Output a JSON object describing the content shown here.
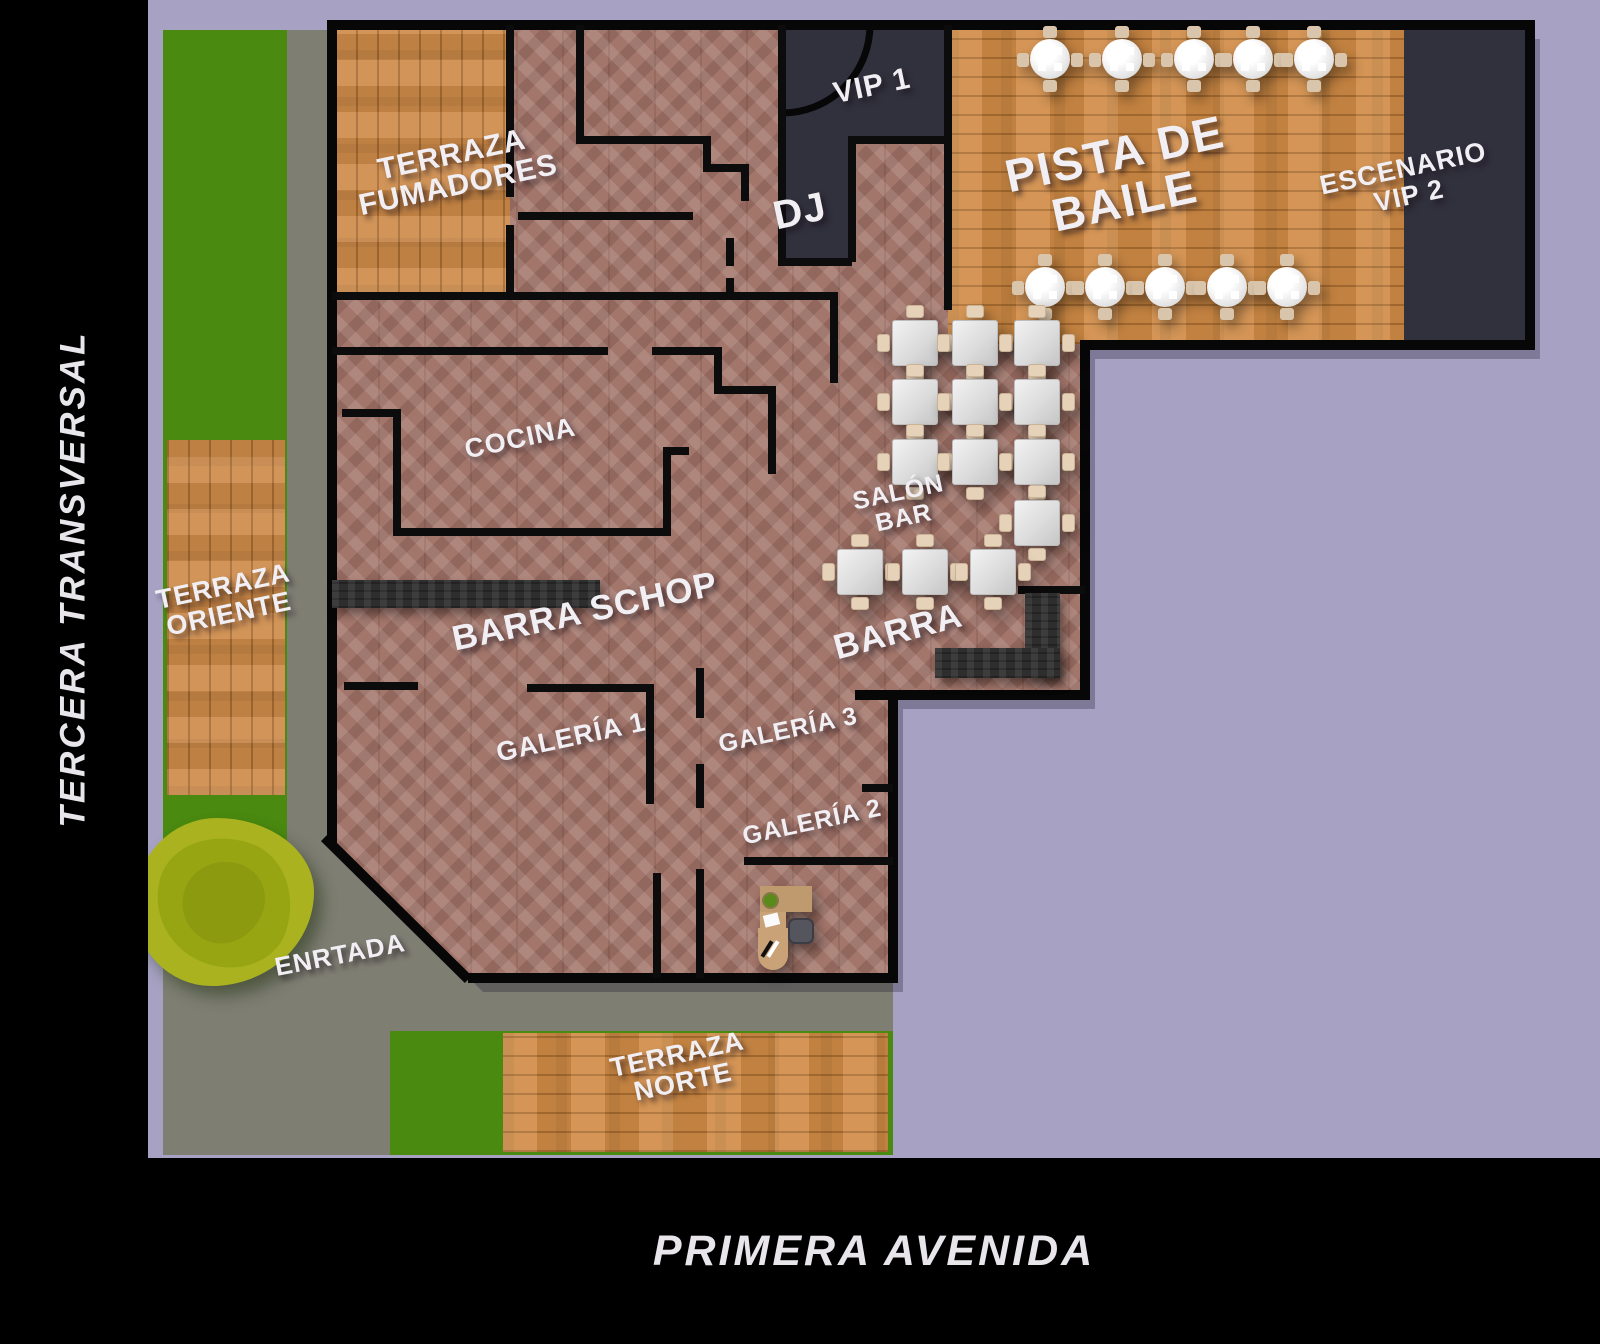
{
  "title": "Plano del local — floor plan",
  "colors": {
    "background_lavender": "#a7a2c4",
    "street_black": "#000000",
    "grass_green": "#4a8a10",
    "road_gray": "#7e7e73",
    "brick_floor": "#a3766b",
    "deck_wood": "#cd8a48",
    "dance_wood": "#d08b45",
    "dark_room": "#31313d",
    "counter_dark": "#2e2e2e",
    "wall_black": "#070707",
    "table_white": "#ececec",
    "chair_beige": "#d9c5ab",
    "desk_tan": "#c9a377",
    "tree_green": "#aab31f",
    "label_white": "#f1eff3"
  },
  "streets": {
    "left_vertical": "TERCERA TRANSVERSAL",
    "bottom_horizontal": "PRIMERA AVENIDA"
  },
  "labels": {
    "terraza_fumadores": {
      "text": "TERRAZA\nFUMADORES"
    },
    "vip1": {
      "text": "VIP 1"
    },
    "dj": {
      "text": "DJ"
    },
    "pista_de_baile": {
      "text": "PISTA DE\nBAILE"
    },
    "escenario_vip2": {
      "text": "ESCENARIO\nVIP 2"
    },
    "cocina": {
      "text": "COCINA"
    },
    "salon_bar": {
      "text": "SALÓN\nBAR"
    },
    "barra_schop": {
      "text": "BARRA SCHOP"
    },
    "barra": {
      "text": "BARRA"
    },
    "galeria_1": {
      "text": "GALERÍA 1"
    },
    "galeria_3": {
      "text": "GALERÍA 3"
    },
    "galeria_2": {
      "text": "GALERÍA 2"
    },
    "terraza_oriente": {
      "text": "TERRAZA\nORIENTE"
    },
    "entrada": {
      "text": "ENRTADA"
    },
    "terraza_norte": {
      "text": "TERRAZA\nNORTE"
    }
  },
  "furniture": {
    "dance_floor_round_tables": [
      [
        902,
        59
      ],
      [
        974,
        59
      ],
      [
        1046,
        59
      ],
      [
        1105,
        59
      ],
      [
        1166,
        59
      ],
      [
        897,
        287
      ],
      [
        957,
        287
      ],
      [
        1017,
        287
      ],
      [
        1079,
        287
      ],
      [
        1139,
        287
      ]
    ],
    "salon_bar_square_tables": [
      [
        767,
        343
      ],
      [
        827,
        343
      ],
      [
        889,
        343
      ],
      [
        767,
        402
      ],
      [
        827,
        402
      ],
      [
        889,
        402
      ],
      [
        767,
        462
      ],
      [
        827,
        462
      ],
      [
        889,
        462
      ],
      [
        889,
        523
      ],
      [
        712,
        572
      ],
      [
        777,
        572
      ],
      [
        845,
        572
      ]
    ],
    "reception_desk": {
      "present": true
    },
    "tree": {
      "present": true
    }
  }
}
